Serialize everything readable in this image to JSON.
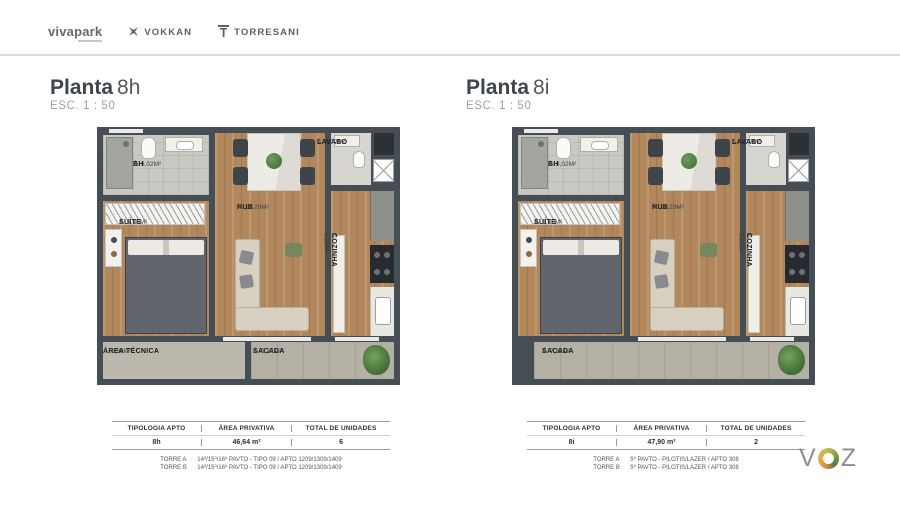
{
  "header": {
    "logos": [
      {
        "label": "vivapark"
      },
      {
        "label": "VOKKAN"
      },
      {
        "label": "TORRESANI"
      }
    ]
  },
  "plans": [
    {
      "title_bold": "Planta",
      "title_num": "8h",
      "scale": "ESC. 1 : 50",
      "rooms": {
        "bh": {
          "name": "BH",
          "area": "Á. 3,02M²"
        },
        "suite": {
          "name": "SUÍTE",
          "area": "Á. 8,85M²"
        },
        "hub": {
          "name": "HUB",
          "area": "Á. 14,20M²"
        },
        "lavabo": {
          "name": "LAVABO",
          "area": "Á. 1,77M²"
        },
        "cozinha": {
          "name": "COZINHA",
          "area": "Á. 6,29M²"
        },
        "area_tecnica": {
          "name": "ÁREA TÉCNICA",
          "area": "Á. 1,38M²"
        },
        "sacada": {
          "name": "SACADA",
          "area": "Á. 5,17M²"
        }
      },
      "table": {
        "headers": [
          "TIPOLOGIA APTO",
          "ÁREA PRIVATIVA",
          "TOTAL DE UNIDADES"
        ],
        "values": [
          "8h",
          "46,64 m²",
          "6"
        ]
      },
      "footnotes": [
        {
          "tower": "TORRE A",
          "detail": "14º/15º/16º PAVTO - TIPO 09 / APTO 1209/1309/1409"
        },
        {
          "tower": "TORRE B",
          "detail": "14º/15º/16º PAVTO - TIPO 09 / APTO 1209/1309/1409"
        }
      ]
    },
    {
      "title_bold": "Planta",
      "title_num": "8i",
      "scale": "ESC. 1 : 50",
      "rooms": {
        "bh": {
          "name": "BH",
          "area": "Á. 3,02M²"
        },
        "suite": {
          "name": "SUÍTE",
          "area": "Á. 8,85M²"
        },
        "hub": {
          "name": "HUB",
          "area": "Á. 14,29M²"
        },
        "lavabo": {
          "name": "LAVABO",
          "area": "Á. 1,77M²"
        },
        "cozinha": {
          "name": "COZINHA",
          "area": "Á. 6,21M²"
        },
        "sacada": {
          "name": "SACADA",
          "area": "Á. 7,32M²"
        }
      },
      "table": {
        "headers": [
          "TIPOLOGIA APTO",
          "ÁREA PRIVATIVA",
          "TOTAL DE UNIDADES"
        ],
        "values": [
          "8i",
          "47,90 m²",
          "2"
        ]
      },
      "footnotes": [
        {
          "tower": "TORRE A",
          "detail": "5º PAVTO - PILOTIS/LAZER / APTO 308"
        },
        {
          "tower": "TORRE B",
          "detail": "5º PAVTO - PILOTIS/LAZER / APTO 308"
        }
      ]
    }
  ],
  "footer_logo": {
    "v": "V",
    "z": "Z"
  },
  "colors": {
    "wall": "#454d55",
    "wood_floor": "#b1875b",
    "voz_orange": "#e09040",
    "voz_green": "#7fa348",
    "text_dark": "#2c3034"
  }
}
